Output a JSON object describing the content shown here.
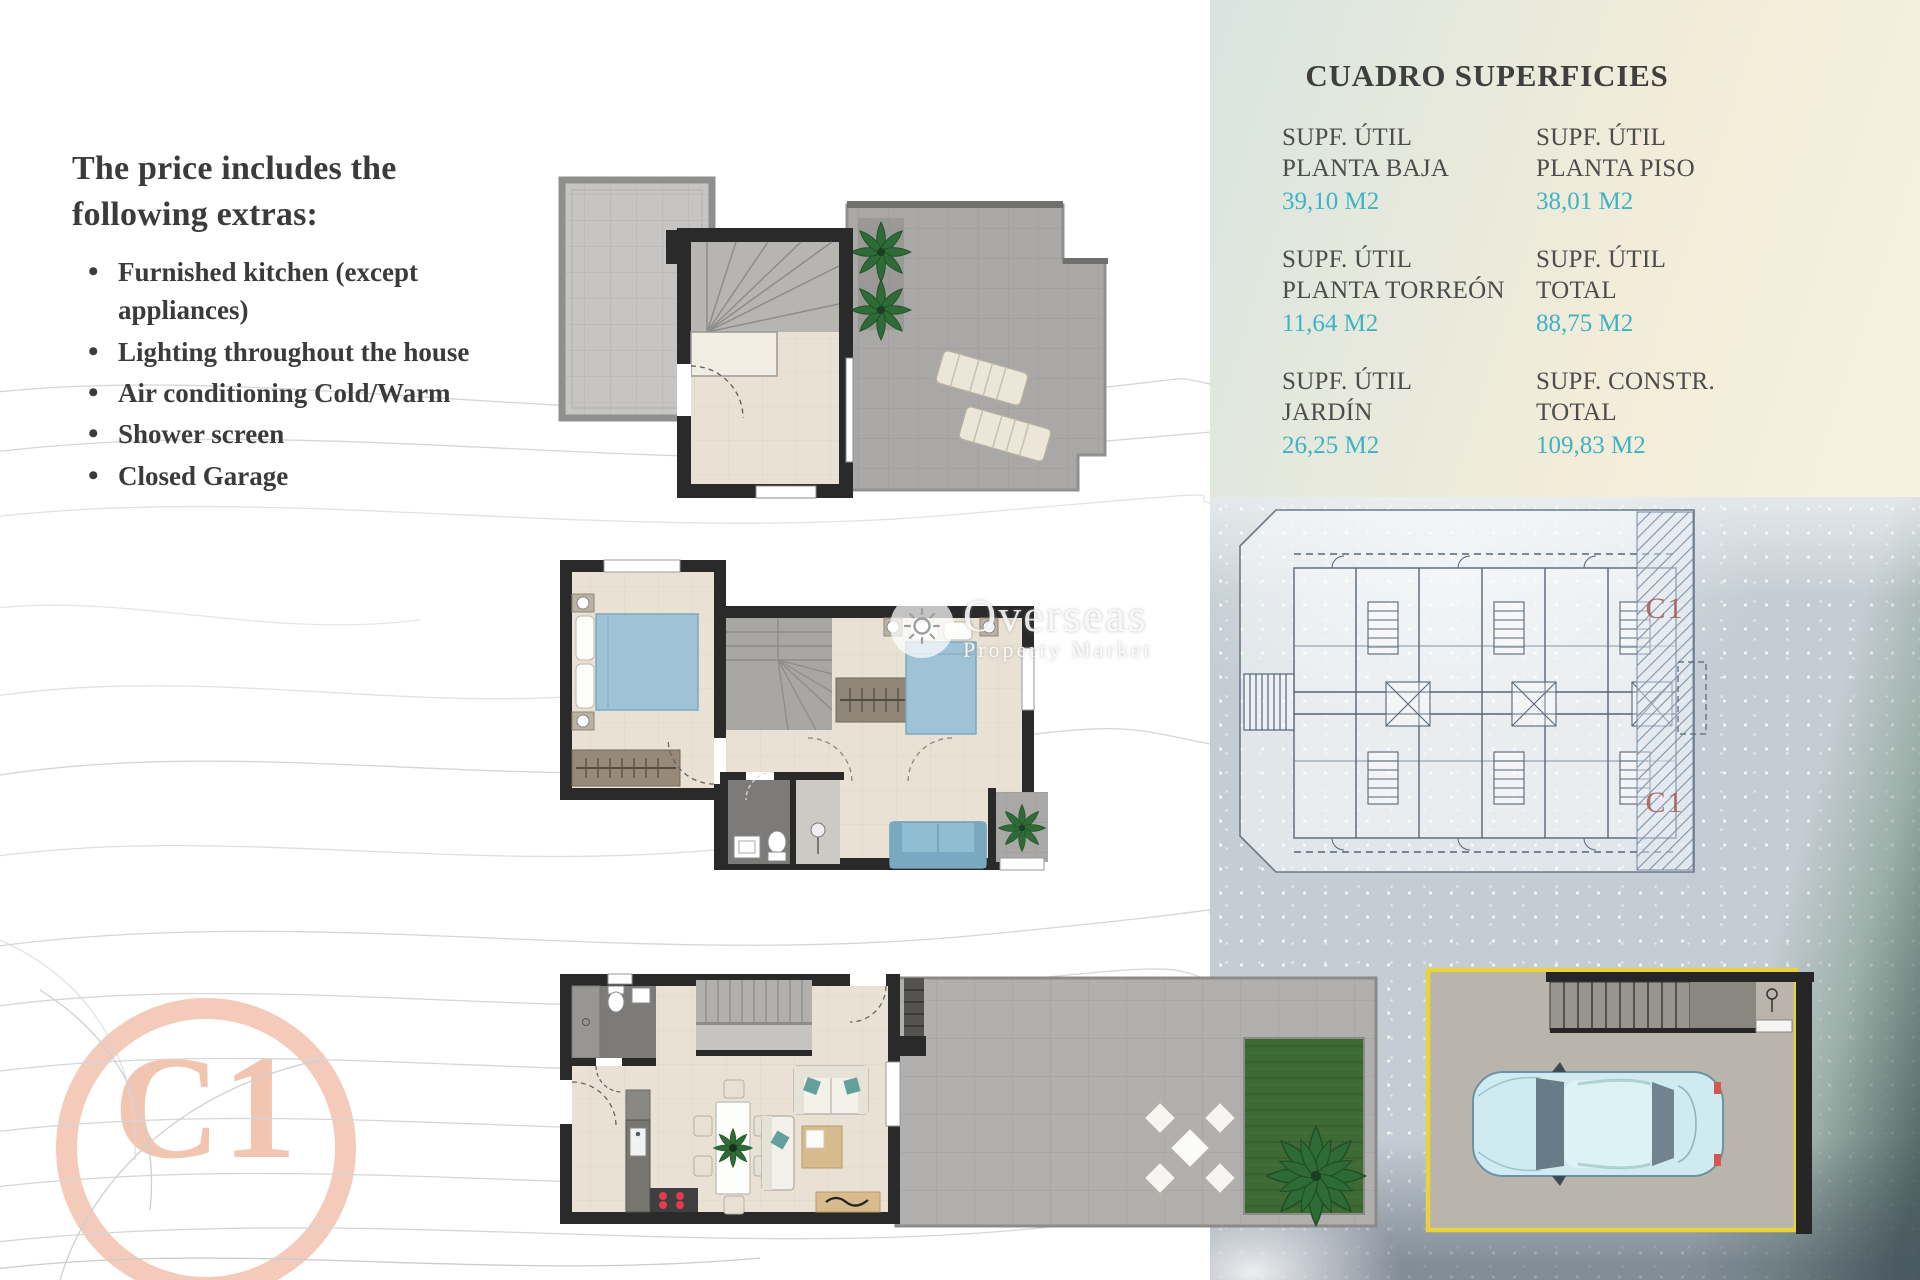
{
  "extras": {
    "heading": "The price includes the following extras:",
    "items": [
      "Furnished kitchen (except appliances)",
      "Lighting throughout the house",
      "Air conditioning Cold/Warm",
      "Shower screen",
      "Closed Garage"
    ]
  },
  "surfaces_table": {
    "title": "CUADRO SUPERFICIES",
    "cells": [
      {
        "label_line1": "SUPF. ÚTIL",
        "label_line2": "PLANTA BAJA",
        "value": "39,10 M2"
      },
      {
        "label_line1": "SUPF. ÚTIL",
        "label_line2": "PLANTA PISO",
        "value": "38,01 M2"
      },
      {
        "label_line1": "SUPF. ÚTIL",
        "label_line2": "PLANTA TORREÓN",
        "value": "11,64 M2"
      },
      {
        "label_line1": "SUPF. ÚTIL",
        "label_line2": "TOTAL",
        "value": "88,75 M2"
      },
      {
        "label_line1": "SUPF. ÚTIL",
        "label_line2": "JARDÍN",
        "value": "26,25 M2"
      },
      {
        "label_line1": "SUPF. CONSTR.",
        "label_line2": "TOTAL",
        "value": "109,83 M2"
      }
    ]
  },
  "unit_badge": "C1",
  "siteplan_unit_labels": [
    "C1",
    "C1"
  ],
  "watermark": {
    "line1": "Overseas",
    "line2": "Property Market"
  },
  "colors": {
    "accent-cyan": "#3fb3c6",
    "text-dark": "#3b3b3c",
    "label-gray": "#4c4c4c",
    "badge-salmon": "#f2c5b1",
    "siteplan-red": "#a85a52",
    "garage-yellow": "#e8d23e",
    "furniture-blue": "#9ec3d6",
    "garden-green": "#3e6a33",
    "wall-black": "#2a2a2a"
  }
}
